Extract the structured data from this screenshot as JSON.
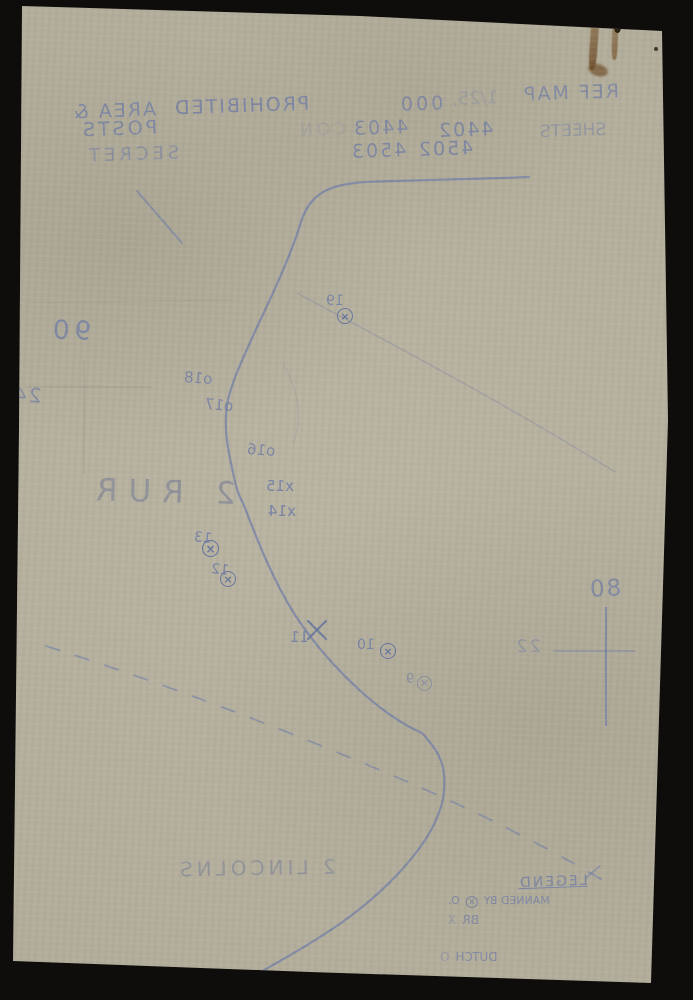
{
  "header": {
    "ref_label": "REF MAP",
    "scale_prefix": "1/25,",
    "scale_zeros": "000",
    "prohibited": "PROHIBITED",
    "area_amp": "AREA &",
    "sheets_label": "SHEETS",
    "sheet_row1_a": "4402",
    "sheet_row1_b": "4403",
    "ghost_text": "CON",
    "posts_label": "POSTS",
    "sheet_row2_a": "4502",
    "sheet_row2_b": "4503",
    "secret_label": "SECRET"
  },
  "grid": {
    "label_left_top": "90",
    "label_left_mid": "24",
    "label_right_top": "80",
    "label_right_mid": "22"
  },
  "units": {
    "unit_north": "2 RUR",
    "unit_south": "2 LINCOLNS"
  },
  "posts": [
    {
      "label": "19"
    },
    {
      "label": "o18"
    },
    {
      "label": "o17"
    },
    {
      "label": "o16"
    },
    {
      "label": "x15"
    },
    {
      "label": "x14"
    },
    {
      "label": "13"
    },
    {
      "label": "12"
    },
    {
      "label": "11"
    },
    {
      "label": "10"
    },
    {
      "label": "9"
    }
  ],
  "legend": {
    "title": "LEGEND",
    "rows": [
      {
        "symbol": "⊗",
        "abbrev": "O.",
        "label": "MANNED BY"
      },
      {
        "symbol": "X",
        "abbrev": "",
        "label": "BR"
      },
      {
        "symbol": "O",
        "abbrev": "",
        "label": "DUTCH"
      }
    ]
  },
  "colors": {
    "background": "#0e0d0b",
    "paper": "#b2ad9b",
    "ink_blue": "#6e7ba6",
    "pencil_grey": "#878b98",
    "stain_brown": "#7a5731"
  }
}
